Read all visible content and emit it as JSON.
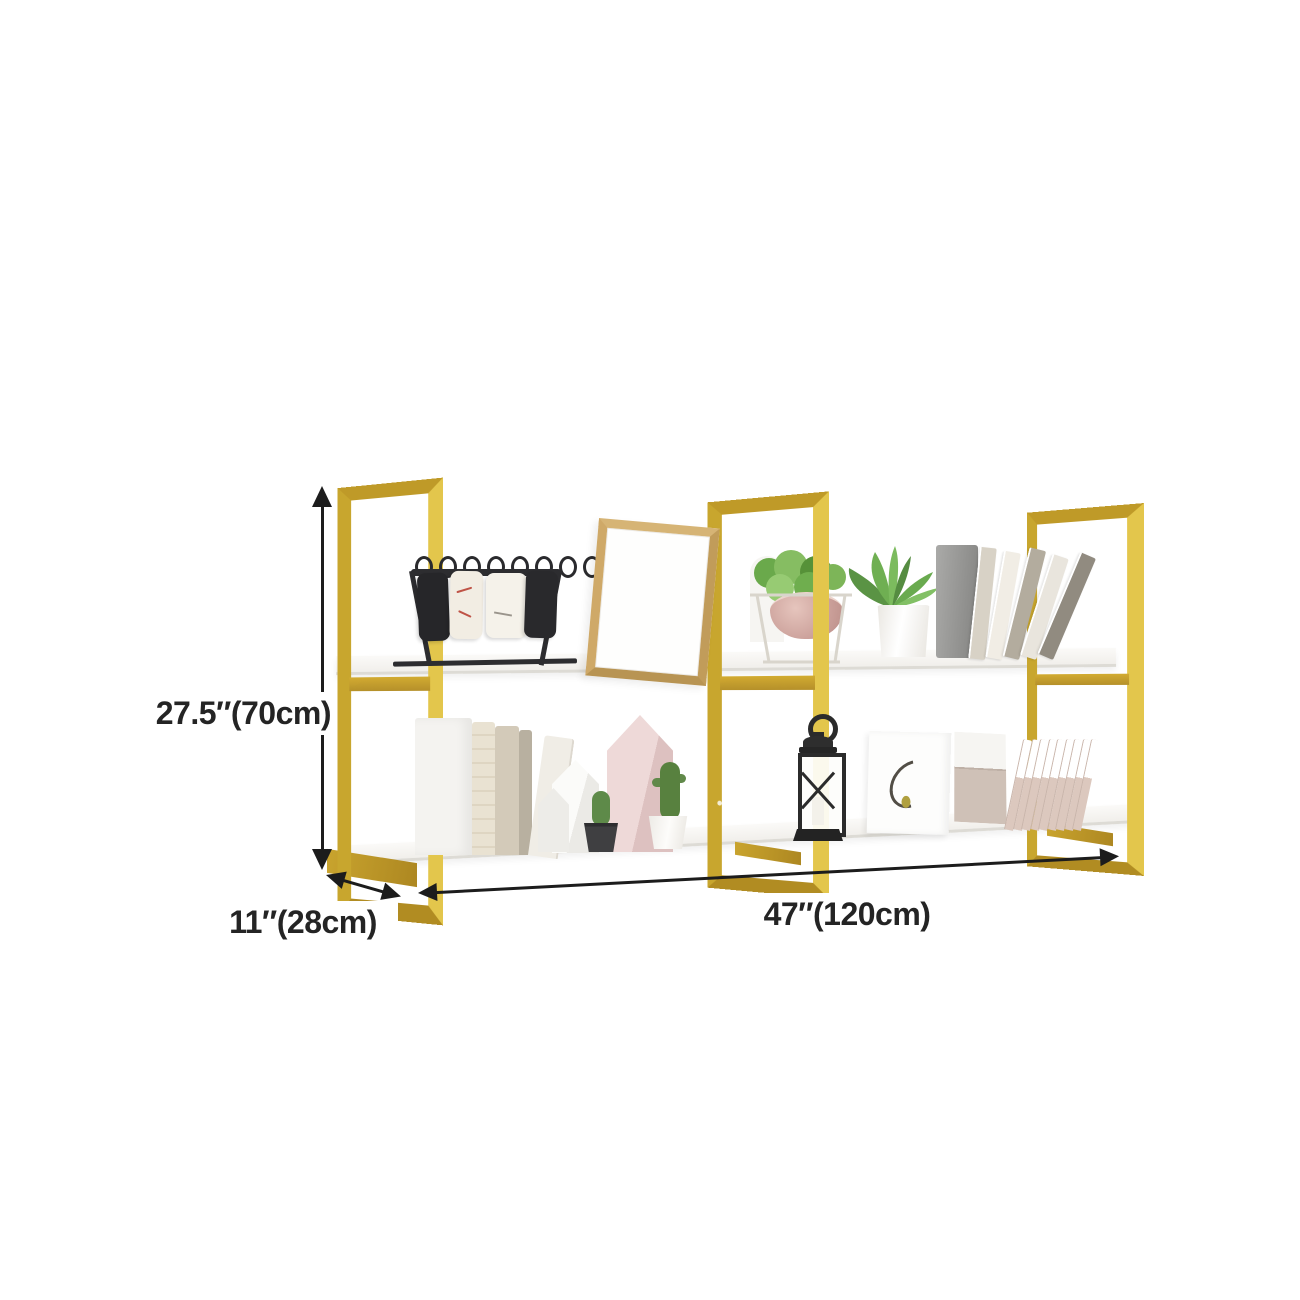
{
  "page": {
    "background_color": "#ffffff",
    "content_type": "furniture product dimension image"
  },
  "product": {
    "name": "two-tier gold metal wall-mounted shelf with white shelf boards",
    "colors": {
      "frame_gold": "#c9a42e",
      "frame_gold_light": "#e3c64c",
      "frame_gold_dark": "#ad8721",
      "shelf_white": "#f6f5f2"
    }
  },
  "annotations": {
    "height_label": "27.5″(70cm)",
    "depth_label": "11″(28cm)",
    "width_label": "47″(120cm)",
    "line_color": "#1c1c1c"
  },
  "decor_items": [
    "flip-desk-calendar",
    "wooden-picture-frame",
    "potted-plant-in-wire-stand",
    "aloe-plant-white-pot",
    "grey-storage-box",
    "leaning-magazines",
    "cream-books",
    "white-house-ornaments",
    "pink-house-ornament",
    "cactus-black-pot",
    "cactus-white-pot",
    "black-candle-lantern",
    "canvas-print",
    "leaning-file-folders"
  ]
}
